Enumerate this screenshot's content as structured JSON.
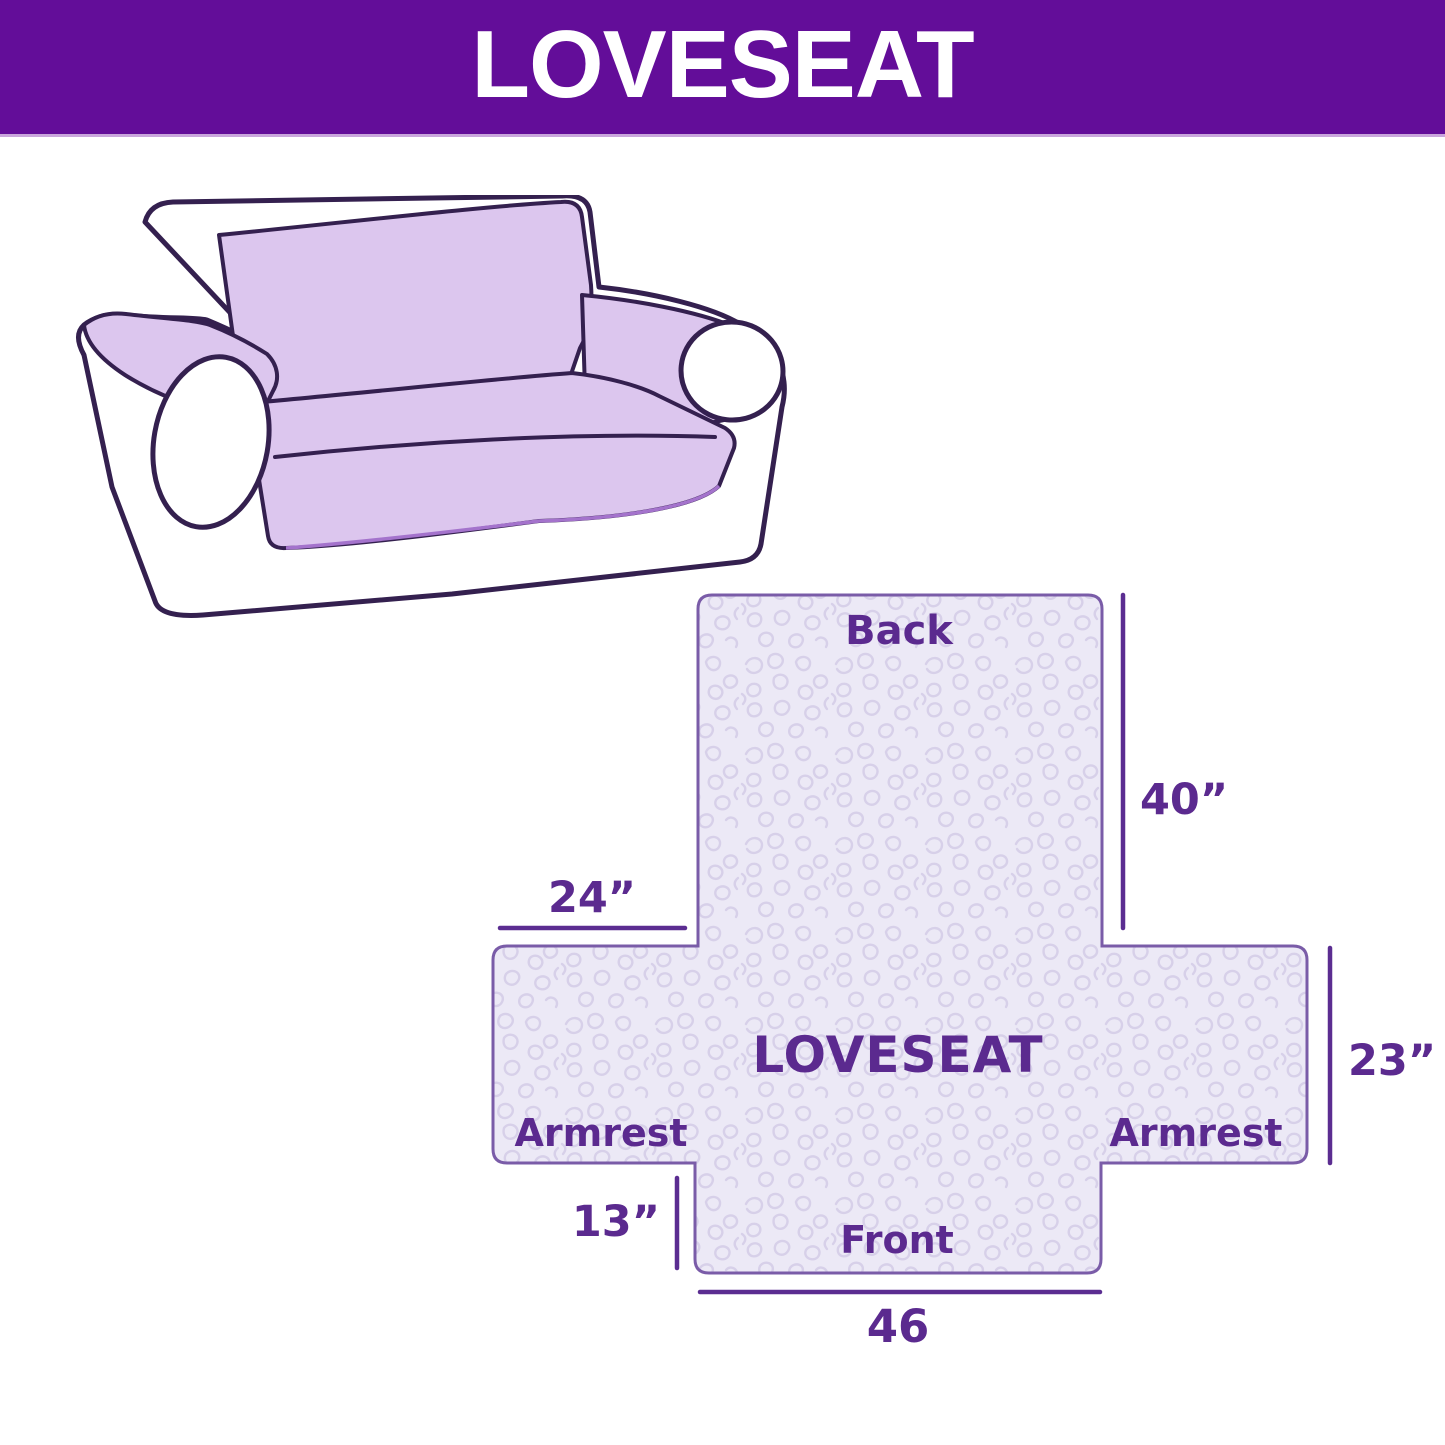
{
  "header": {
    "title": "LOVESEAT",
    "background_color": "#630d99",
    "underline_color": "#c9a6dc",
    "text_color": "#ffffff"
  },
  "illustration": {
    "description": "loveseat sofa line drawing with light purple slipcover on back, inner arms and seat",
    "cover_color": "#dcc6ee",
    "outline_color": "#34204f",
    "drape_accent_color": "#a473cc"
  },
  "diagram": {
    "center_label": "LOVESEAT",
    "sections": {
      "back": "Back",
      "front": "Front",
      "armrest_left": "Armrest",
      "armrest_right": "Armrest"
    },
    "dimensions": {
      "back_height": "40”",
      "armrest_top_width": "24”",
      "armrest_height": "23”",
      "front_skirt_height": "13”",
      "front_width": "46"
    },
    "colors": {
      "fill": "#ece9f6",
      "quilt_pattern": "#d7d0e9",
      "outline": "#7a5ca8",
      "label_text": "#5b2a8f",
      "dimension_line": "#5b2d91"
    }
  }
}
